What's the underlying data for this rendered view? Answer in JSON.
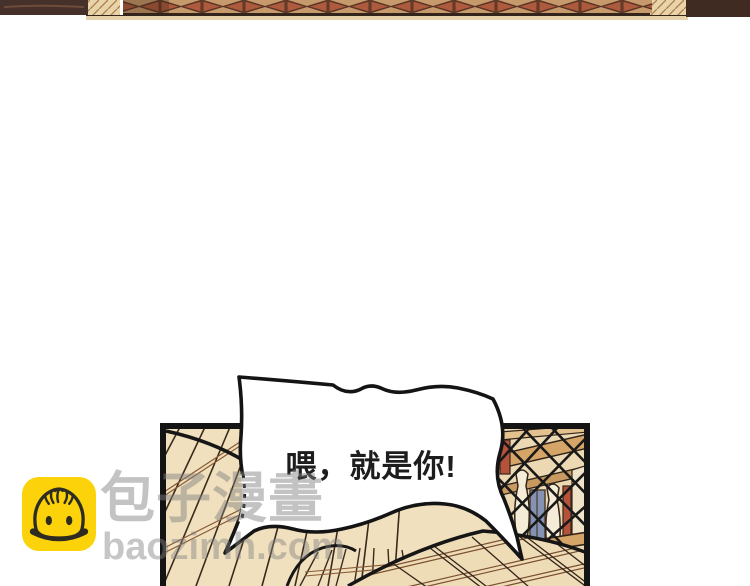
{
  "panel": {
    "speech_bubble_text": "喂，就是你!"
  },
  "watermark": {
    "icon": "baozi-bun-icon",
    "icon_bg": "#fcd30a",
    "brand_name": "包子漫畫",
    "brand_domain": "baozimh.com",
    "text_color": "#c8c8c8"
  },
  "artwork_colors": {
    "eave_pattern_tan": "#c69a6b",
    "eave_pattern_rust": "#ae5a3d",
    "eave_outline": "#5a3526",
    "dark_brown_block": "#44302a",
    "roof_tan": "#f0e0bd",
    "beam_tan": "#d5a568",
    "window_blue": "#8492b3",
    "pole_red": "#b4523a",
    "baluster_cream": "#f5ecd8",
    "ink": "#161616"
  }
}
